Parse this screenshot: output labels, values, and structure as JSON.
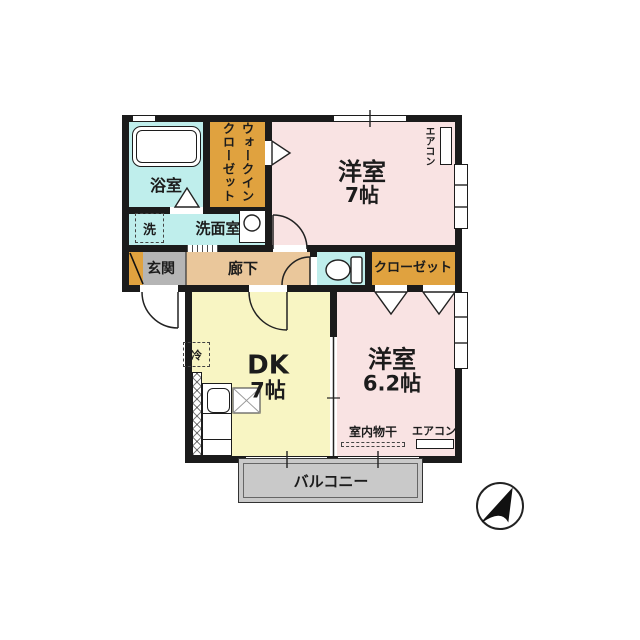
{
  "plan": {
    "colors": {
      "wall": "#1b1b1b",
      "cyan": "#bfeeec",
      "orange": "#e0a23f",
      "pink": "#f9e3e3",
      "yellow": "#f8f5c3",
      "hallway_tan": "#eac79b",
      "entrance_gray": "#b5b5b5",
      "balcony_gray": "#c9c9c9",
      "background": "#ffffff"
    },
    "rooms": {
      "bath": {
        "label": "浴室",
        "color": "#bfeeec"
      },
      "walk_in_closet": {
        "label": "ウォークインクローゼット",
        "color": "#e0a23f"
      },
      "bedroom7": {
        "label": "洋室",
        "size": "7帖",
        "color": "#f9e3e3"
      },
      "washroom": {
        "label": "洗面室",
        "color": "#bfeeec"
      },
      "laundry": {
        "label": "洗"
      },
      "entrance": {
        "label": "玄関",
        "color": "#b5b5b5"
      },
      "hallway": {
        "label": "廊下",
        "color": "#eac79b"
      },
      "toilet": {
        "color": "#bfeeec"
      },
      "closet": {
        "label": "クローゼット",
        "color": "#e0a23f"
      },
      "dk": {
        "label": "DK",
        "size": "7帖",
        "color": "#f8f5c3"
      },
      "bedroom62": {
        "label": "洋室",
        "size": "6.2帖",
        "color": "#f9e3e3"
      },
      "balcony": {
        "label": "バルコニー",
        "color": "#c9c9c9"
      }
    },
    "annotations": {
      "aircon_vertical": "エアコン",
      "aircon_horizontal": "エアコン",
      "indoor_drying": "室内物干",
      "fridge": "冷"
    },
    "compass": {
      "icon": "north-arrow"
    }
  }
}
